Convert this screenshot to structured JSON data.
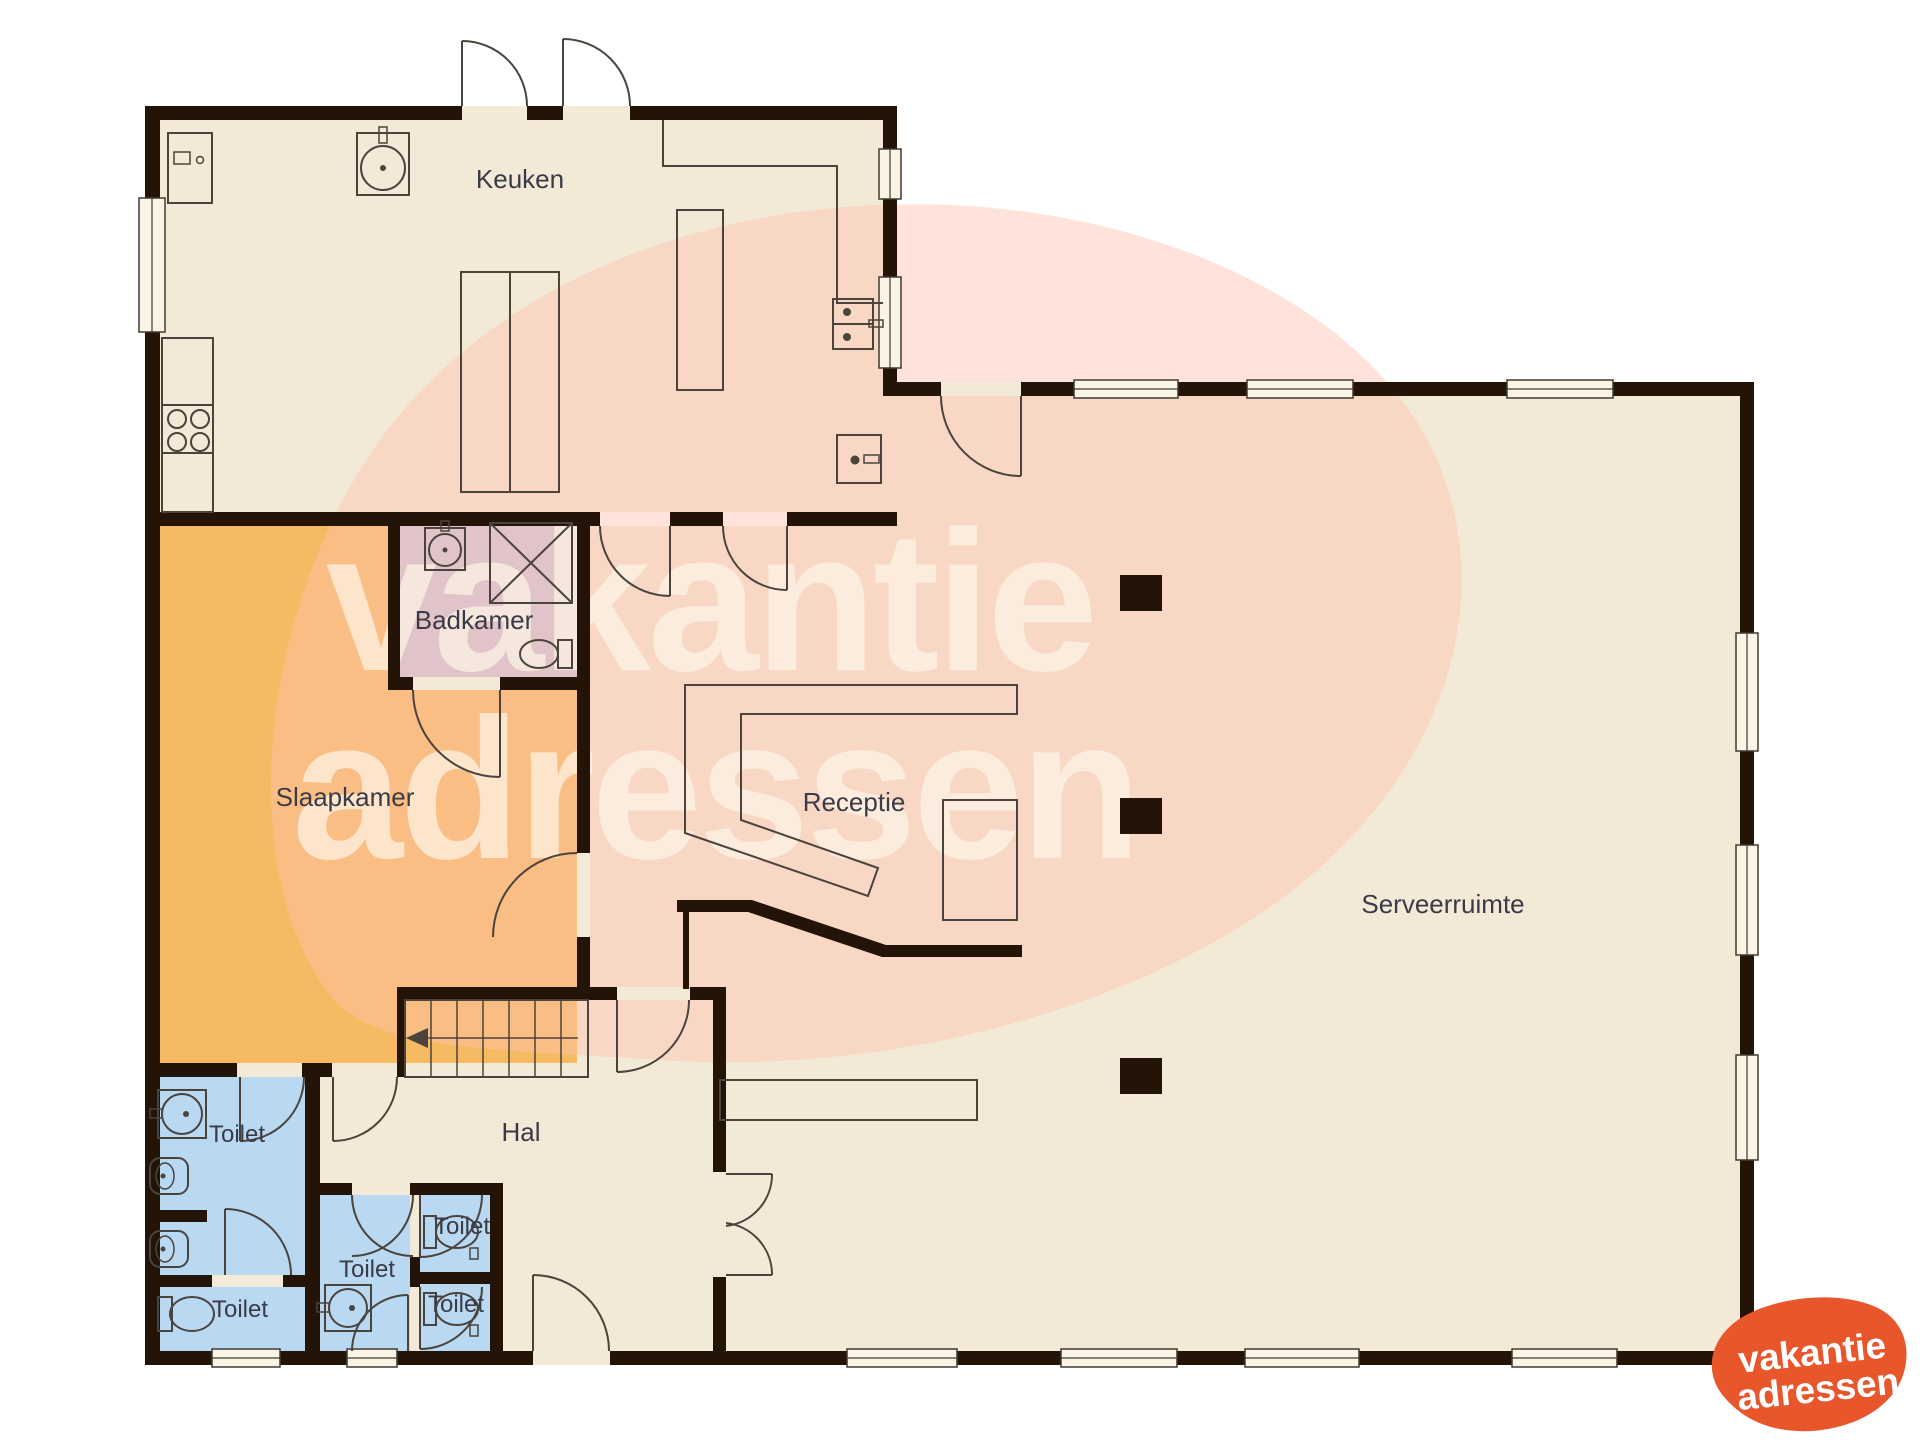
{
  "plan": {
    "rooms": [
      {
        "name": "keuken",
        "label": "Keuken"
      },
      {
        "name": "badkamer",
        "label": "Badkamer"
      },
      {
        "name": "slaapkamer",
        "label": "Slaapkamer"
      },
      {
        "name": "receptie",
        "label": "Receptie"
      },
      {
        "name": "serveerruimte",
        "label": "Serveerruimte"
      },
      {
        "name": "hal",
        "label": "Hal"
      },
      {
        "name": "toilet-groot",
        "label": "Toilet"
      },
      {
        "name": "toilet-linksonder",
        "label": "Toilet"
      },
      {
        "name": "toilet-midden",
        "label": "Toilet"
      },
      {
        "name": "toilet-rechtsboven",
        "label": "Toilet"
      },
      {
        "name": "toilet-rechtsonder",
        "label": "Toilet"
      }
    ],
    "watermark": {
      "line1": "vakantie",
      "line2": "adressen"
    },
    "logo": {
      "line1": "vakantie",
      "line2": "adressen"
    },
    "colors": {
      "wall": "#241408",
      "floor_beige": "#f3e9d7",
      "slaapkamer_orange": "#f6ba62",
      "badkamer_lavender": "#c9c7e1",
      "toilet_blue": "#b9d8f2",
      "watermark_pink": "#f9dcce",
      "logo_orange": "#e8562b"
    }
  }
}
